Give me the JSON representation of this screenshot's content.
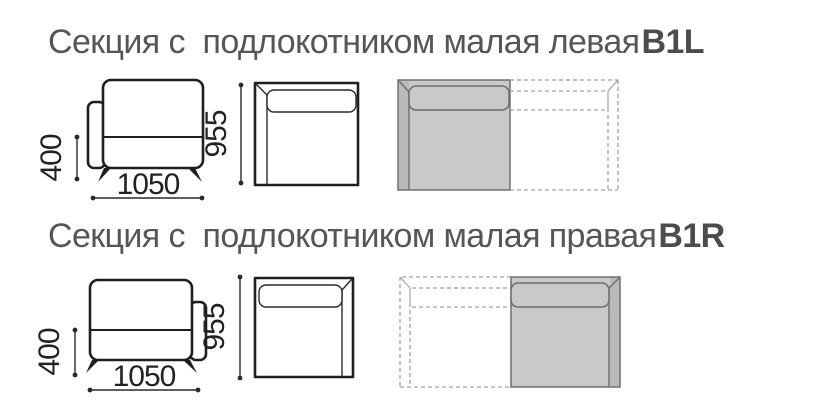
{
  "document": {
    "type": "furniture-spec-diagram",
    "background": "#ffffff"
  },
  "colors": {
    "title_text": "#565659",
    "drawing_line": "#1f1f1f",
    "dimension_text": "#222222",
    "section_fill": "#c8c9c9",
    "section_armrest_fill": "#b9baba",
    "section_outline": "#6e6e6e",
    "ghost_dash": "#a2a2a2"
  },
  "sections": [
    {
      "title": "Секция с  подлокотником малая левая",
      "code": "B1L",
      "armrest_side": "left",
      "dims": {
        "seat_height": "400",
        "width": "1050",
        "depth": "955"
      }
    },
    {
      "title": "Секция с  подлокотником малая правая",
      "code": "B1R",
      "armrest_side": "right",
      "dims": {
        "seat_height": "400",
        "width": "1050",
        "depth": "955"
      }
    }
  ]
}
